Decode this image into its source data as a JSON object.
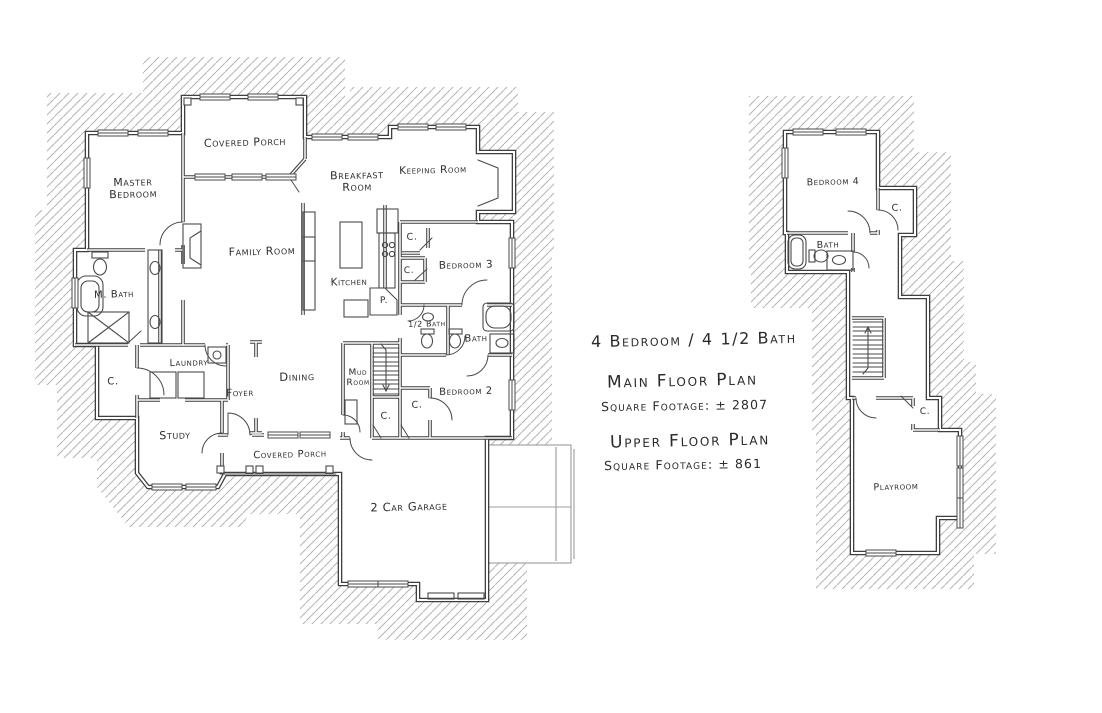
{
  "colors": {
    "pencil": "#3f3f3f",
    "thin": "#4a4a4a",
    "hatch": "#b4b4b4",
    "faint": "#9c9c9c",
    "paper": "#ffffff"
  },
  "summary": {
    "bed_bath": "4 Bedroom / 4 1/2 Bath",
    "main_floor_heading": "Main Floor Plan",
    "main_floor_sqft": "Square Footage: ± 2807",
    "upper_floor_heading": "Upper Floor Plan",
    "upper_floor_sqft": "Square Footage: ± 861"
  },
  "main_floor": {
    "rooms": {
      "covered_porch_top": "Covered Porch",
      "master_bedroom": "Master Bedroom",
      "breakfast_room": "Breakfast Room",
      "keeping_room": "Keeping Room",
      "family_room": "Family Room",
      "kitchen": "Kitchen",
      "bedroom_3": "Bedroom 3",
      "m_bath": "M. Bath",
      "half_bath": "1/2 Bath",
      "bath": "Bath",
      "laundry": "Laundry",
      "foyer": "Foyer",
      "dining": "Dining",
      "mud_room": "Mud Room",
      "bedroom_2": "Bedroom 2",
      "study": "Study",
      "covered_porch_bottom": "Covered Porch",
      "garage": "2 Car Garage",
      "pantry": "P.",
      "closet": "C."
    }
  },
  "upper_floor": {
    "rooms": {
      "bedroom_4": "Bedroom 4",
      "bath": "Bath",
      "playroom": "Playroom",
      "closet": "C."
    }
  }
}
